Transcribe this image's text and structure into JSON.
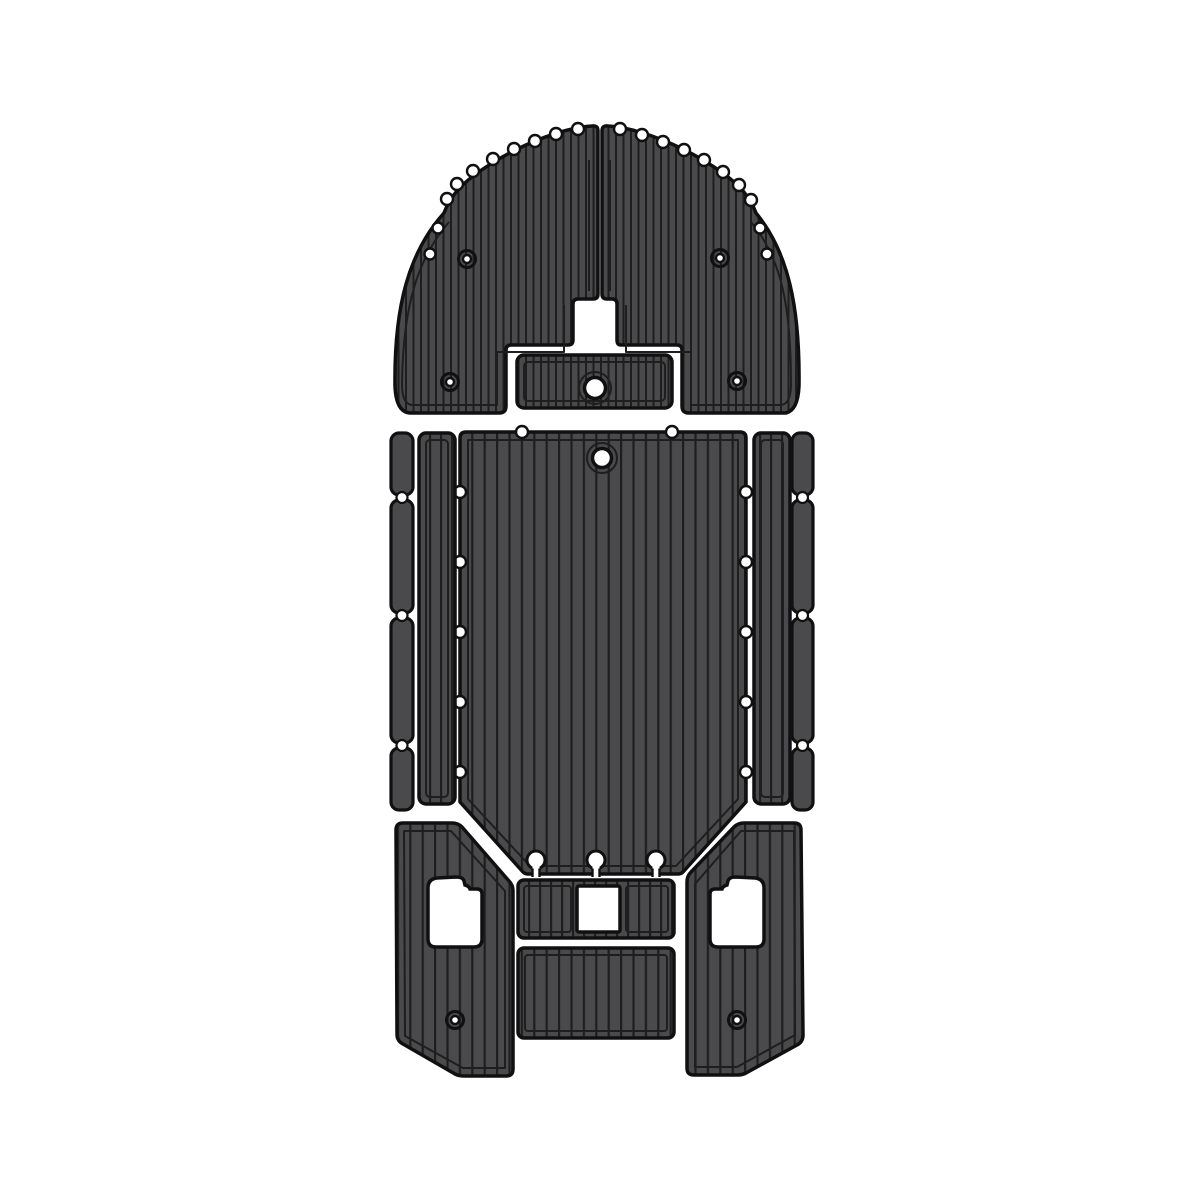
{
  "canvas": {
    "width": 1200,
    "height": 1200
  },
  "colors": {
    "background": "#ffffff",
    "foam": "#4a4a4c",
    "groove": "#1e1e1e",
    "outline": "#101010",
    "hole": "#ffffff"
  },
  "subject": "boat-eva-foam-deck-pad-set-top-view",
  "panels": [
    {
      "name": "bow-pad-port",
      "texture": "vertical-teak-grooves",
      "edge": "scalloped-plank-steps"
    },
    {
      "name": "bow-pad-starboard",
      "texture": "vertical-teak-grooves",
      "edge": "scalloped-plank-steps"
    },
    {
      "name": "bow-hatch-pad",
      "texture": "vertical-teak-grooves",
      "openings": [
        "round-hole"
      ]
    },
    {
      "name": "cockpit-floor-pad",
      "texture": "vertical-teak-grooves",
      "openings": [
        "round-hole",
        "keyhole-slot",
        "keyhole-slot",
        "keyhole-slot"
      ]
    },
    {
      "name": "side-runner-port",
      "texture": "vertical-teak-grooves"
    },
    {
      "name": "side-runner-starboard",
      "texture": "vertical-teak-grooves"
    },
    {
      "name": "gunwale-strip-column-port",
      "segments": 4
    },
    {
      "name": "gunwale-strip-column-starboard",
      "segments": 4
    },
    {
      "name": "transom-pad-port",
      "texture": "vertical-teak-grooves",
      "openings": [
        "bracket-cutout",
        "screw-hole"
      ]
    },
    {
      "name": "transom-pad-starboard",
      "texture": "vertical-teak-grooves",
      "openings": [
        "bracket-cutout",
        "screw-hole"
      ]
    },
    {
      "name": "console-step-pad",
      "texture": "vertical-teak-grooves",
      "openings": [
        "square-cutout"
      ]
    },
    {
      "name": "transom-step-pad",
      "texture": "vertical-teak-grooves"
    }
  ],
  "features": {
    "bow_screw_holes": 4,
    "transom_screw_holes": 2,
    "keyhole_slots": 3,
    "round_openings": 2,
    "edge_notches_per_floor_side": 5
  }
}
